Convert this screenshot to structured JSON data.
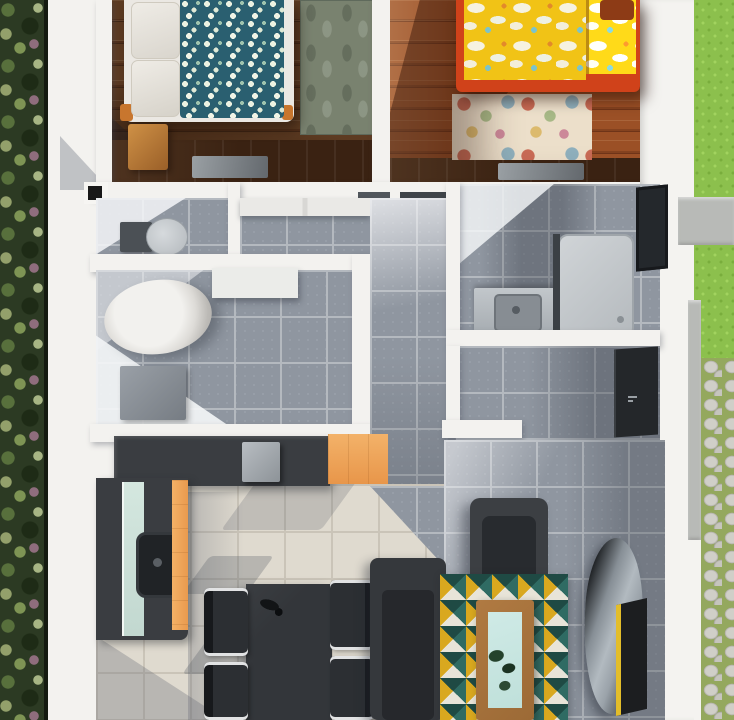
{
  "scene": {
    "view": "top-down 3D architectural render of a small house floor plan",
    "no_visible_text": true,
    "rooms": [
      {
        "name": "bedroom-left",
        "floor": "dark walnut planks",
        "furniture": [
          "double-bed-teal-floral-duvet",
          "white-pillows",
          "wood-nightstand",
          "gray-area-rug",
          "low-dresser-with-glass"
        ]
      },
      {
        "name": "bedroom-right",
        "floor": "orange oak planks",
        "furniture": [
          "double-bed-yellow-floral-duvet",
          "red-orange-bed-frame",
          "pastel-floral-rug",
          "low-dresser-with-glass"
        ]
      },
      {
        "name": "wc",
        "floor": "gray ceramic tile",
        "furniture": [
          "toilet"
        ]
      },
      {
        "name": "closet-nook",
        "floor": "gray ceramic tile",
        "furniture": [
          "white-wardrobe"
        ]
      },
      {
        "name": "laundry-utility",
        "floor": "gray ceramic tile",
        "furniture": [
          "washing-machine-cylinder",
          "gray-hamper-box",
          "white-cabinet"
        ]
      },
      {
        "name": "bathroom",
        "floor": "gray ceramic tile",
        "furniture": [
          "vanity-sink",
          "shower-tray",
          "window"
        ]
      },
      {
        "name": "entry",
        "floor": "gray ceramic tile",
        "furniture": [
          "entrance-door"
        ]
      },
      {
        "name": "hallway",
        "floor": "gray ceramic tile",
        "furniture": []
      },
      {
        "name": "kitchen",
        "floor": "cream tile",
        "furniture": [
          "l-shaped-dark-counter",
          "orange-cabinet-fronts",
          "mint-glass-panel",
          "undermount-sink",
          "countertop-appliance"
        ]
      },
      {
        "name": "dining",
        "floor": "cream tile",
        "furniture": [
          "dark-dining-table",
          "four-chairs",
          "table-vase"
        ]
      },
      {
        "name": "living",
        "floor": "gray ceramic tile",
        "furniture": [
          "armchair",
          "sofa",
          "triangle-pattern-rug",
          "wood-coffee-table-glass-top",
          "potted-plants",
          "chaise-lounge",
          "tv-panel"
        ]
      }
    ],
    "exterior": [
      "tree-canopy-strip-left",
      "white-walkway",
      "lawn-top-right",
      "concrete-pad",
      "cobblestone-path-with-grass-joints"
    ]
  },
  "colors": {
    "veg": "#2c3a23",
    "grass": "#8cc04d",
    "tile": "#8f96a0",
    "grout": "#b4b9bf",
    "cream": "#dfdacf",
    "cream-grout": "#cac4b8",
    "wood-dark": "#5d3b22",
    "wood-orange": "#9b5026",
    "duvet-teal": "#2a5f70",
    "duvet-yellow": "#f1c316",
    "bed-red": "#d0421a",
    "orange": "#f3b269",
    "mint": "#d4e7df",
    "counter": "#3a3d41",
    "rug-teal": "#2f6b63",
    "rug-mustard": "#d9a81f",
    "rug-deep": "#1f4a44",
    "rug-cream": "#e8e4d8",
    "table-wood": "#9c6a36",
    "glass": "#cfeae6",
    "door": "#24272a"
  }
}
